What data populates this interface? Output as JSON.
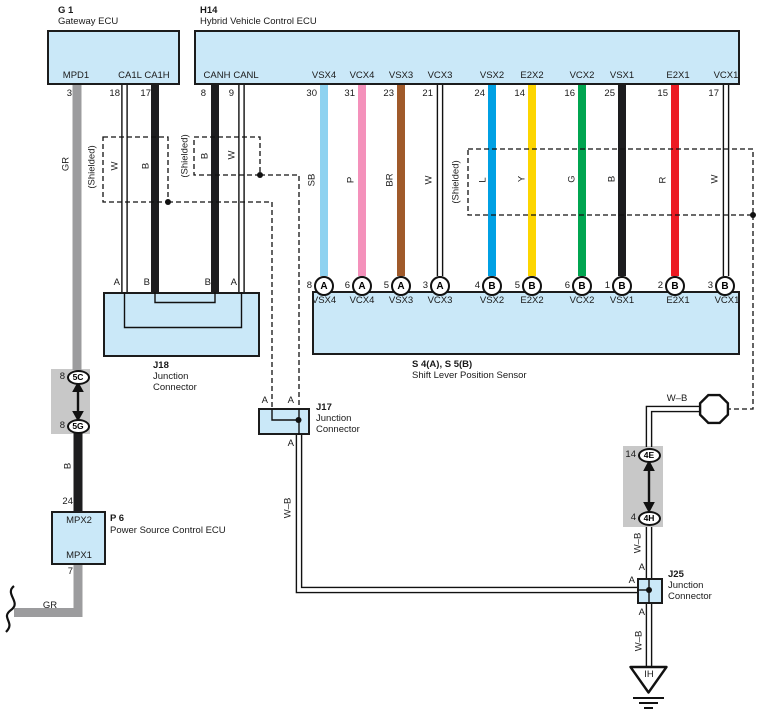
{
  "ecu_g1": {
    "code": "G 1",
    "title": "Gateway ECU",
    "pins": [
      {
        "label": "MPD1",
        "num": "3",
        "color": "GR"
      },
      {
        "label": "CA1L",
        "num": "18",
        "color": "W"
      },
      {
        "label": "CA1H",
        "num": "17",
        "color": "B"
      }
    ]
  },
  "ecu_h14": {
    "code": "H14",
    "title": "Hybrid Vehicle Control ECU",
    "pins": [
      {
        "label": "CANH",
        "num": "8",
        "color": "B"
      },
      {
        "label": "CANL",
        "num": "9",
        "color": "W"
      },
      {
        "label": "VSX4",
        "num": "30",
        "color": "SB"
      },
      {
        "label": "VCX4",
        "num": "31",
        "color": "P"
      },
      {
        "label": "VSX3",
        "num": "23",
        "color": "BR"
      },
      {
        "label": "VCX3",
        "num": "21",
        "color": "W"
      },
      {
        "label": "VSX2",
        "num": "24",
        "color": "L"
      },
      {
        "label": "E2X2",
        "num": "14",
        "color": "Y"
      },
      {
        "label": "VCX2",
        "num": "16",
        "color": "G"
      },
      {
        "label": "VSX1",
        "num": "25",
        "color": "B"
      },
      {
        "label": "E2X1",
        "num": "15",
        "color": "R"
      },
      {
        "label": "VCX1",
        "num": "17",
        "color": "W"
      }
    ]
  },
  "shielded_label": "(Shielded)",
  "sensor": {
    "code": "S 4(A), S 5(B)",
    "title": "Shift Lever Position Sensor",
    "terminals": [
      {
        "num": "8",
        "letter": "A",
        "label": "VSX4"
      },
      {
        "num": "6",
        "letter": "A",
        "label": "VCX4"
      },
      {
        "num": "5",
        "letter": "A",
        "label": "VSX3"
      },
      {
        "num": "3",
        "letter": "A",
        "label": "VCX3"
      },
      {
        "num": "4",
        "letter": "B",
        "label": "VSX2"
      },
      {
        "num": "5",
        "letter": "B",
        "label": "E2X2"
      },
      {
        "num": "6",
        "letter": "B",
        "label": "VCX2"
      },
      {
        "num": "1",
        "letter": "B",
        "label": "VSX1"
      },
      {
        "num": "2",
        "letter": "B",
        "label": "E2X1"
      },
      {
        "num": "3",
        "letter": "B",
        "label": "VCX1"
      }
    ]
  },
  "j18": {
    "code": "J18",
    "name_l1": "Junction",
    "name_l2": "Connector",
    "terminals": [
      "A",
      "B",
      "B",
      "A"
    ]
  },
  "j17": {
    "code": "J17",
    "name_l1": "Junction",
    "name_l2": "Connector",
    "top_terminals": [
      "A",
      "A"
    ],
    "bottom_terminal": "A"
  },
  "j25": {
    "code": "J25",
    "name_l1": "Junction",
    "name_l2": "Connector",
    "terminals": {
      "top": "A",
      "left": "A",
      "bottom": "A"
    }
  },
  "p6": {
    "code": "P 6",
    "title": "Power Source Control ECU",
    "pin_top": {
      "label": "MPX2",
      "num": "24",
      "color": "B"
    },
    "pin_bottom": {
      "label": "MPX1",
      "num": "7",
      "color": "GR"
    }
  },
  "conn_5": {
    "top_num": "8",
    "top_code": "5C",
    "bottom_num": "8",
    "bottom_code": "5G"
  },
  "conn_4": {
    "top_num": "14",
    "top_code": "4E",
    "bottom_num": "4",
    "bottom_code": "4H"
  },
  "wire_labels": {
    "wb": "W–B",
    "gr": "GR"
  },
  "ground": {
    "code": "IH"
  },
  "colors": {
    "box_fill": "#cae8f8",
    "wire_gray": "#9c9c9e",
    "wire_black": "#1d1d1f",
    "wire_sb": "#8ed2f0",
    "wire_p": "#f491bb",
    "wire_br": "#a05a2a",
    "wire_l": "#00a0e4",
    "wire_y": "#fdd500",
    "wire_g": "#00a550",
    "wire_r": "#ec1b24"
  }
}
